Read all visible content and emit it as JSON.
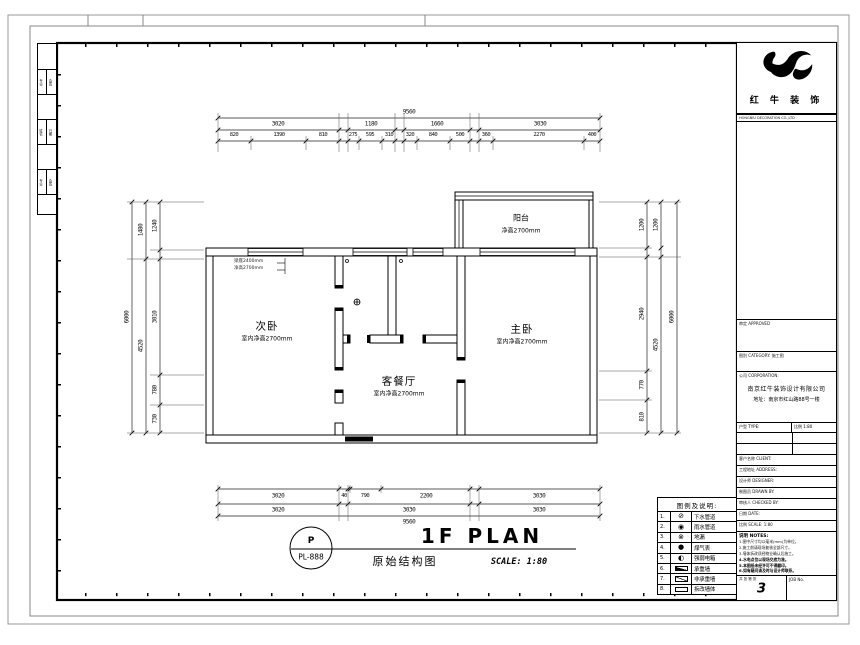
{
  "sheet": {
    "brand": "红 牛 装 饰",
    "brand_sub": "HONGNIU DECORATION CO.,LTD"
  },
  "edge_strip": [
    [
      "专业",
      "会签"
    ],
    [
      "姓名",
      "日期"
    ],
    [
      "专业",
      "会签"
    ]
  ],
  "plan": {
    "rooms": [
      {
        "name": "次卧",
        "note": "室内净高2700mm"
      },
      {
        "name": "主卧",
        "note": "室内净高2700mm"
      },
      {
        "name": "客餐厅",
        "note": "室内净高2700mm"
      },
      {
        "name": "阳台",
        "note": "净高2700mm"
      }
    ],
    "beam_note_line1": "梁底2400mm",
    "beam_note_line2": "净高2700mm"
  },
  "dims": {
    "top_overall": "9560",
    "t2": [
      "3020",
      "1180",
      "1660",
      "3030"
    ],
    "t3": [
      "820",
      "1390",
      "810",
      "275",
      "595",
      "310",
      "320",
      "840",
      "500",
      "360",
      "2270",
      "400"
    ],
    "b1": [
      "3020",
      "40",
      "790",
      "2200",
      "3030"
    ],
    "b2": [
      "3020",
      "3030",
      "3030"
    ],
    "bottom_overall": "9560",
    "left_outer": "6000",
    "l_mid": [
      "1480",
      "4520"
    ],
    "l_in": [
      "1240",
      "3010",
      "780",
      "730"
    ],
    "right_outer": "6000",
    "r_mid": [
      "1200",
      "4520"
    ],
    "r_in": [
      "1200",
      "2940",
      "770",
      "810"
    ]
  },
  "title": {
    "bubble_top": "P",
    "bubble_bottom": "PL-888",
    "plan_name": "1F PLAN",
    "drawing_name": "原始结构图",
    "scale": "SCALE: 1:80"
  },
  "legend": {
    "header": "图例及说明:",
    "rows": [
      {
        "num": "1.",
        "glyph": "⊘",
        "label": "下水管道"
      },
      {
        "num": "2.",
        "glyph": "◉",
        "label": "雨水管道"
      },
      {
        "num": "3.",
        "glyph": "⊗",
        "label": "地漏"
      },
      {
        "num": "4.",
        "glyph": "●",
        "label": "煤气表"
      },
      {
        "num": "5.",
        "glyph": "◐",
        "label": "强弱电箱"
      },
      {
        "num": "6.",
        "glyph": "",
        "label": "承重墙"
      },
      {
        "num": "7.",
        "glyph": "",
        "label": "非承重墙"
      },
      {
        "num": "8.",
        "glyph": "",
        "label": "拆改墙体"
      }
    ]
  },
  "titleblock": {
    "box1_label": "审定 APPROVED",
    "box2_label": "图别 CATEGORY: 施工图",
    "company_label": "公司 CORPORATION:",
    "company_name": "南京红牛装饰设计有限公司",
    "company_addr": "地址：南京市红山路88号一楼",
    "cellA": "户型 TYPE:",
    "cellB": "比例 1:80",
    "rows": [
      "客户名称 CLIENT:",
      "工程地址 ADDRESS:",
      "设计师 DESIGNER:",
      "制图员 DRAWN BY:",
      "审核人 CHECKED BY:",
      "日期 DATE:",
      "比例 SCALE: 1:80"
    ],
    "notes_title": "说明 NOTES:",
    "notes": [
      "1.图中尺寸均以毫米(mm)为单位。",
      "2.施工前请现场复核全部尺寸。",
      "3.墙体拆改须经物业确认后施工。",
      "4.水电点位以现场交底为准。",
      "5.本图纸未经许可不得翻印。",
      "6.如有疑问请及时与设计师联系。"
    ],
    "sheet_label": "共 张 第 张",
    "sheet_no": "3",
    "job_label": "JOB No."
  }
}
